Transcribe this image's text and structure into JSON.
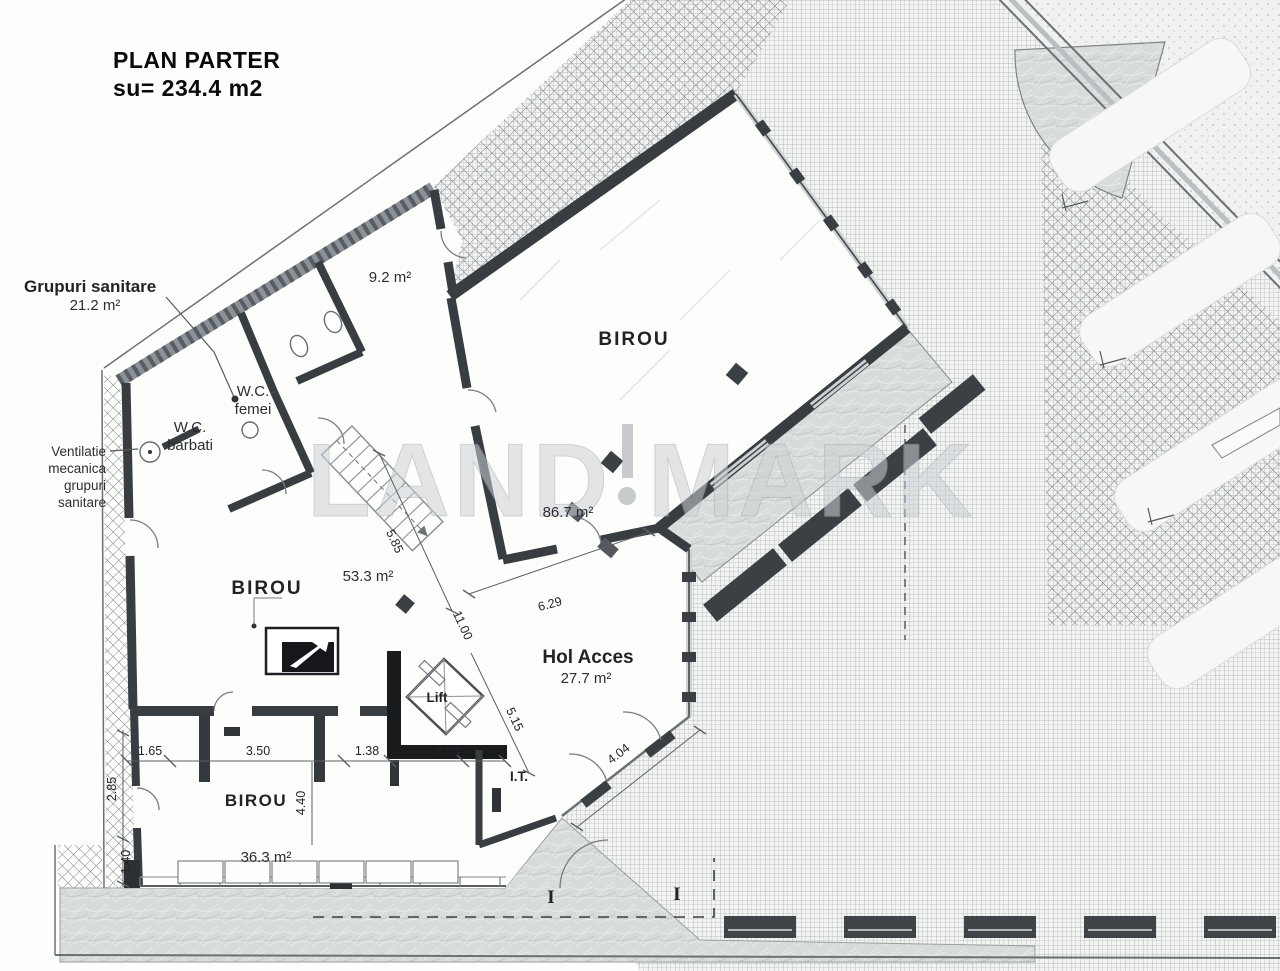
{
  "title": {
    "line1": "PLAN PARTER",
    "line2": "su= 234.4 m2"
  },
  "watermark": {
    "part1": "LAND",
    "part2": "MARK"
  },
  "annotations": {
    "grupuri_sanitare": {
      "label": "Grupuri sanitare",
      "area": "21.2 m²"
    },
    "ventilatie": {
      "line1": "Ventilatie",
      "line2": "mecanica",
      "line3": "grupuri",
      "line4": "sanitare"
    }
  },
  "rooms": {
    "birou_mare": {
      "name": "BIROU",
      "area": "86.7 m²"
    },
    "birou_mijloc": {
      "name": "BIROU",
      "area": "53.3 m²"
    },
    "birou_mic": {
      "name": "BIROU",
      "area": "36.3 m²"
    },
    "camera_mica": {
      "area": "9.2 m²"
    },
    "hol_acces": {
      "name": "Hol Acces",
      "area": "27.7 m²"
    },
    "lift": {
      "name": "Lift"
    },
    "it": {
      "name": "I.T."
    },
    "wc_femei": {
      "line1": "W.C.",
      "line2": "femei"
    },
    "wc_barbati": {
      "line1": "W.C.",
      "line2": "barbati"
    }
  },
  "dimensions": {
    "d1": "5.85",
    "d2": "11.00",
    "d3": "6.29",
    "d4": "5.15",
    "d5": "4.04",
    "d6": "1.65",
    "d7": "3.50",
    "d8": "1.38",
    "d9": "3.04",
    "d10": "2.85",
    "d11": "4.40",
    "d12": "1.40"
  },
  "section_markers": {
    "left": "I",
    "right": "I"
  },
  "colors": {
    "wall": "#383d41",
    "wall_dark": "#1a1b1d",
    "paper": "#fdfdfb",
    "hatch": "#8e9499"
  }
}
